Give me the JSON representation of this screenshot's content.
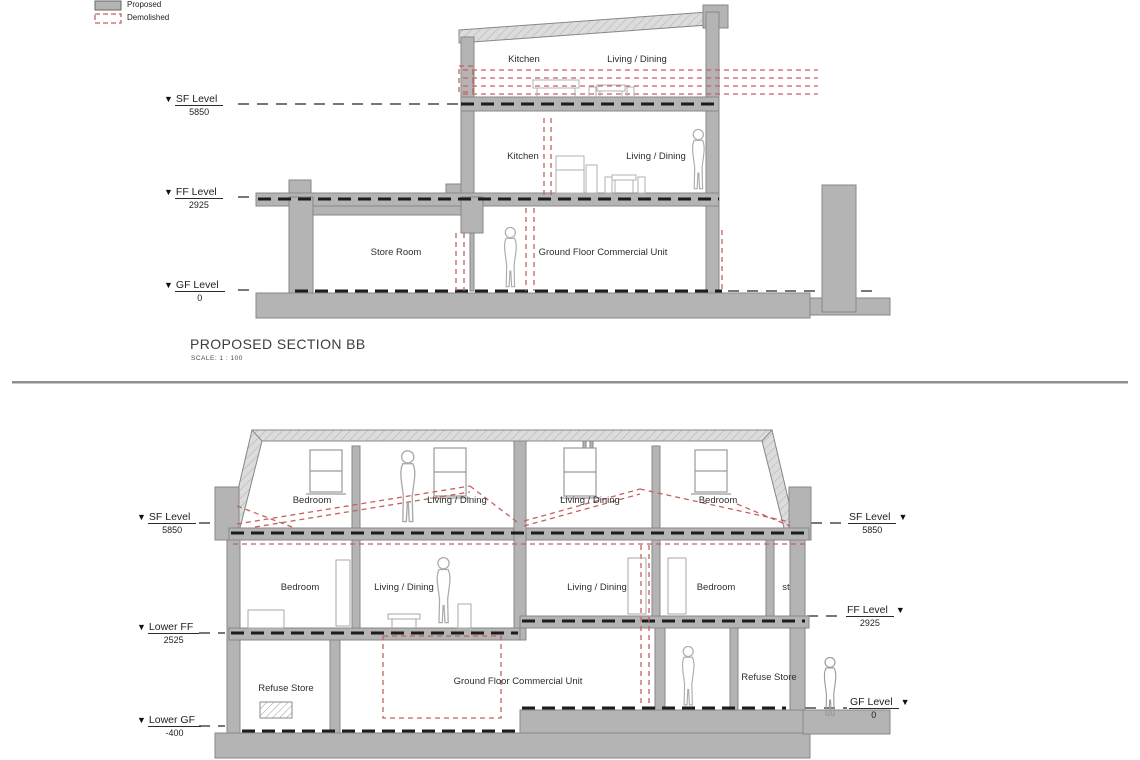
{
  "legend": {
    "items": [
      {
        "label": "Proposed",
        "type": "proposed"
      },
      {
        "label": "Demolished",
        "type": "demolished"
      }
    ]
  },
  "icons": {
    "level_marker": "▼"
  },
  "colors": {
    "proposed_gray": "#b4b4b4",
    "roof_gray": "#dcdcdc",
    "demolished_red": "#c4615c",
    "cut_line_black": "#1c1c1c"
  },
  "section_bb": {
    "title": "PROPOSED SECTION BB",
    "scale": "SCALE:  1 : 100",
    "levels": [
      {
        "name": "SF Level",
        "value": "5850"
      },
      {
        "name": "FF Level",
        "value": "2925"
      },
      {
        "name": "GF Level",
        "value": "0"
      }
    ],
    "rooms": {
      "second_floor": [
        {
          "label": "Kitchen"
        },
        {
          "label": "Living / Dining"
        }
      ],
      "first_floor": [
        {
          "label": "Kitchen"
        },
        {
          "label": "Living / Dining"
        }
      ],
      "ground_floor": [
        {
          "label": "Store Room"
        },
        {
          "label": "Ground Floor Commercial Unit"
        }
      ]
    }
  },
  "section_two": {
    "levels_left": [
      {
        "name": "SF Level",
        "value": "5850"
      },
      {
        "name": "Lower FF",
        "value": "2525"
      },
      {
        "name": "Lower GF",
        "value": "-400"
      }
    ],
    "levels_right": [
      {
        "name": "SF Level",
        "value": "5850"
      },
      {
        "name": "FF Level",
        "value": "2925"
      },
      {
        "name": "GF Level",
        "value": "0"
      }
    ],
    "rooms": {
      "second_floor": [
        {
          "label": "Bedroom"
        },
        {
          "label": "Living / Dining"
        },
        {
          "label": "Living / Dining"
        },
        {
          "label": "Bedroom"
        }
      ],
      "first_floor": [
        {
          "label": "Bedroom"
        },
        {
          "label": "Living / Dining"
        },
        {
          "label": "Living / Dining"
        },
        {
          "label": "Bedroom"
        },
        {
          "label": "st"
        }
      ],
      "ground_floor": [
        {
          "label": "Refuse Store"
        },
        {
          "label": "Ground Floor Commercial Unit"
        },
        {
          "label": "Refuse Store"
        }
      ]
    }
  }
}
